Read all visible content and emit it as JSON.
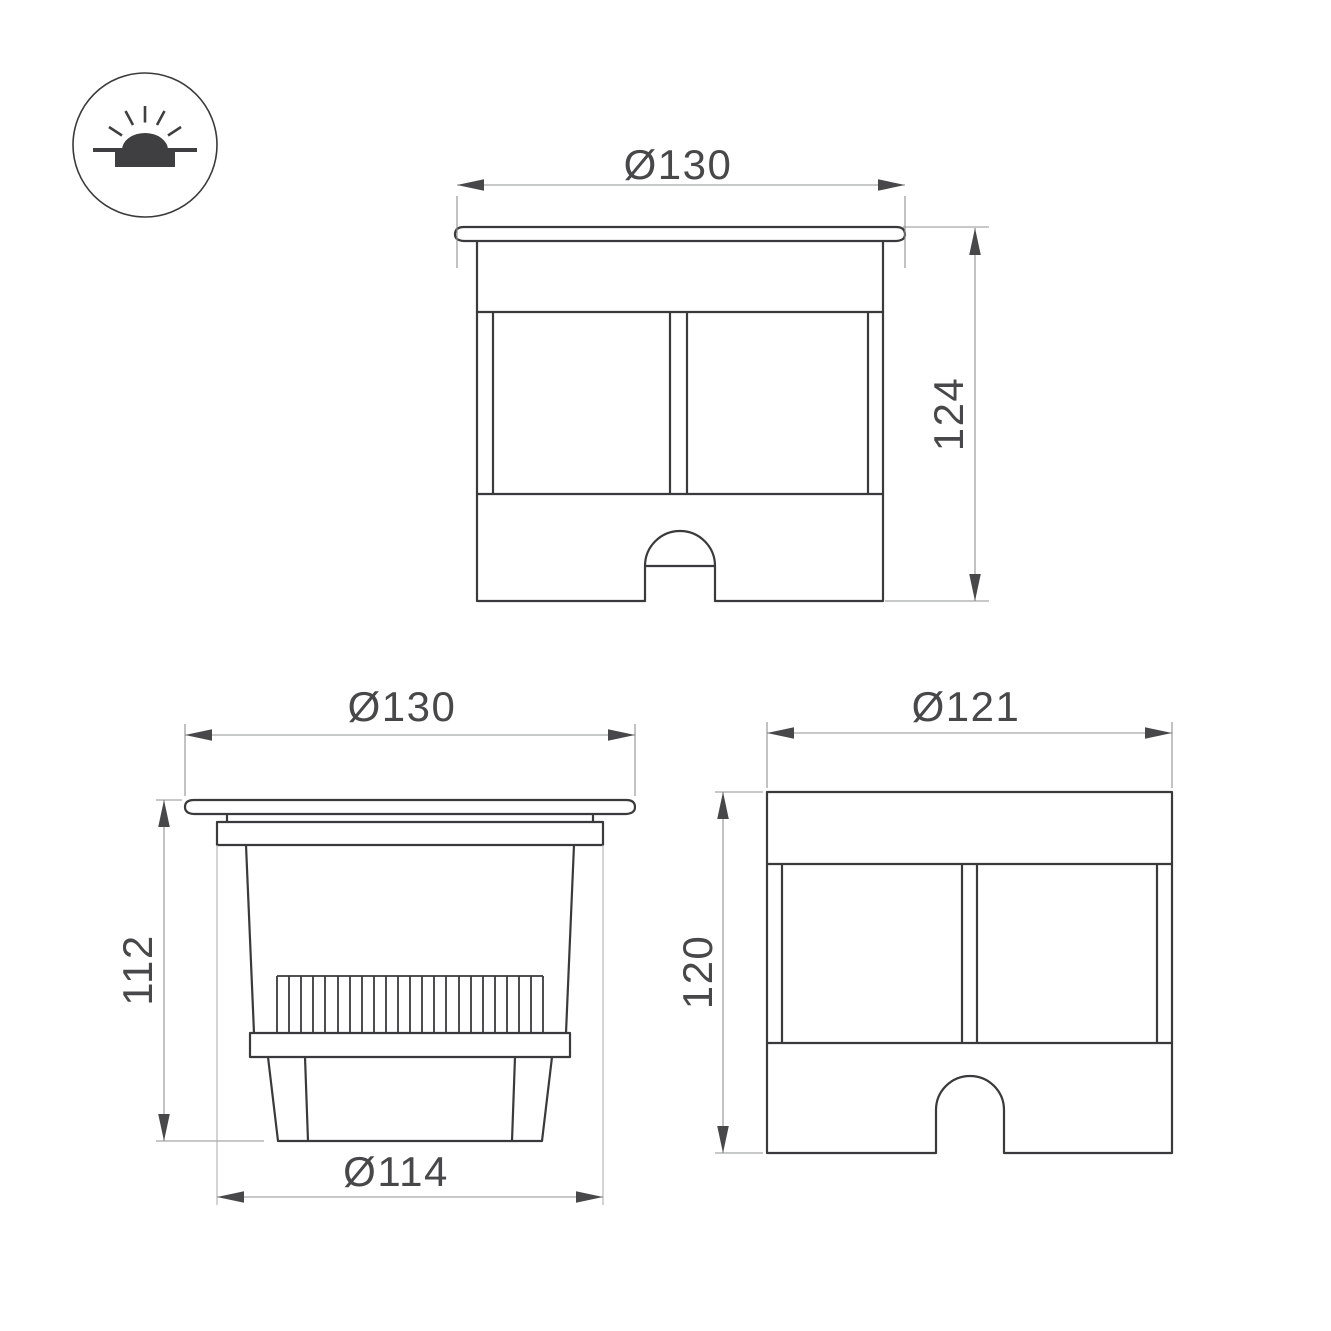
{
  "icon": {
    "name": "recessed-ground-luminaire-icon"
  },
  "views": {
    "front": {
      "width": "Ø130",
      "height": "124"
    },
    "side": {
      "top_width": "Ø130",
      "height": "112",
      "bottom_width": "Ø114"
    },
    "rear": {
      "width": "Ø121",
      "height": "120"
    }
  },
  "colors": {
    "object_line": "#3a3a3c",
    "dimension_line": "#8f9092",
    "extension_line_light": "#b0b0b2",
    "text": "#48484a",
    "background": "#ffffff"
  }
}
